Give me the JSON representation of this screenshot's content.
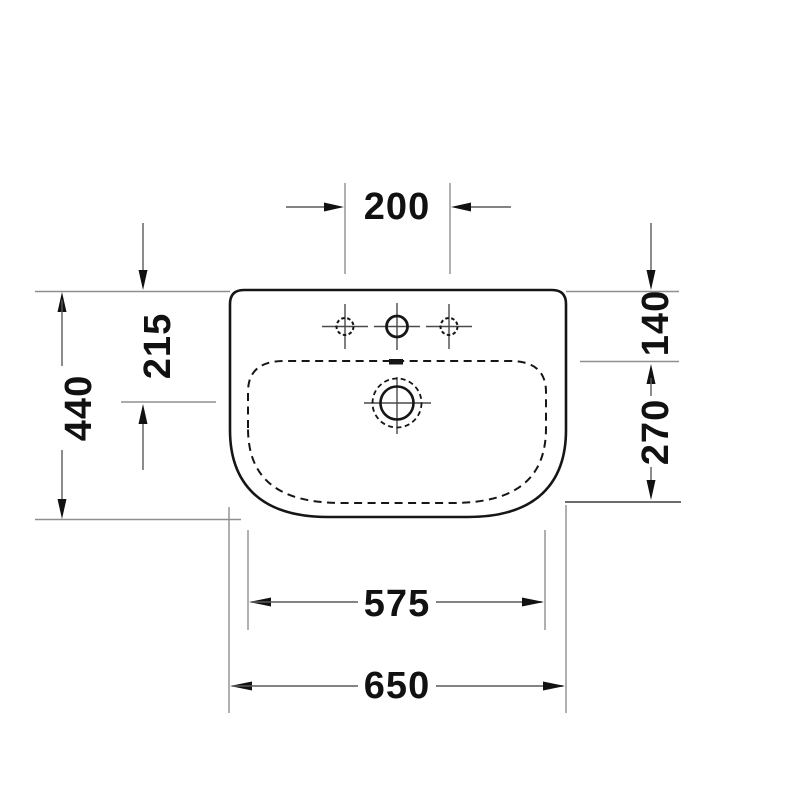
{
  "drawing": {
    "type": "Technical dimension drawing - washbasin top view",
    "labels": {
      "faucet_hole_spacing": "200",
      "rear_to_drain": "215",
      "overall_depth": "440",
      "rear_to_basin": "140",
      "basin_depth": "270",
      "basin_width": "575",
      "overall_width": "650"
    },
    "colors": {
      "background": "#ffffff",
      "outline": "#161616",
      "thin_line": "#8f8f8f",
      "text": "#111111"
    }
  }
}
